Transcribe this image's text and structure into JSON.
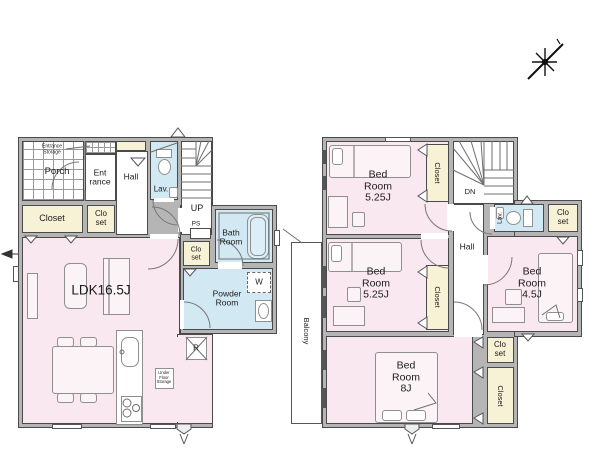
{
  "palette": {
    "wall_fill": "#b5b5b5",
    "wall_line": "#4a4a4a",
    "room_pink": "#f9e8ef",
    "wet_blue": "#d2e9f4",
    "closet_cream": "#f7f1d6",
    "line_gray": "#777777"
  },
  "icons": {
    "compass": "compass-north-star",
    "approach_marker": "entry-arrow",
    "washer_box": "washing-machine-space",
    "fridge_box": "refrigerator-space"
  },
  "floor1": {
    "labels": {
      "entrance_storage": "Entrance\nStorage",
      "porch": "Porch",
      "entrance": "Ent\nrance",
      "hall": "Hall",
      "lav": "Lav.",
      "up": "UP",
      "ps": "PS",
      "closet_large": "Closet",
      "closet_hall": "Clo\nset",
      "ldk": "LDK16.5J",
      "bath": "Bath\nRoom",
      "closet_powder": "Clo\nset",
      "powder": "Powder\nRoom",
      "washer": "W",
      "fridge": "R",
      "under_floor": "Under\nFloor\nStorage"
    }
  },
  "floor2": {
    "labels": {
      "bedroom1": "Bed\nRoom\n5.25J",
      "closet1": "Closet",
      "dn": "DN",
      "hall": "Hall",
      "lav": "Lav.",
      "closet_lav": "Clo\nset",
      "bedroom2": "Bed\nRoom\n5.25J",
      "closet2": "Closet",
      "bedroom3": "Bed\nRoom\n4.5J",
      "closet3": "Clo\nset",
      "closet4": "Closet",
      "bedroom4": "Bed\nRoom\n8J",
      "balcony": "Balcony"
    }
  }
}
